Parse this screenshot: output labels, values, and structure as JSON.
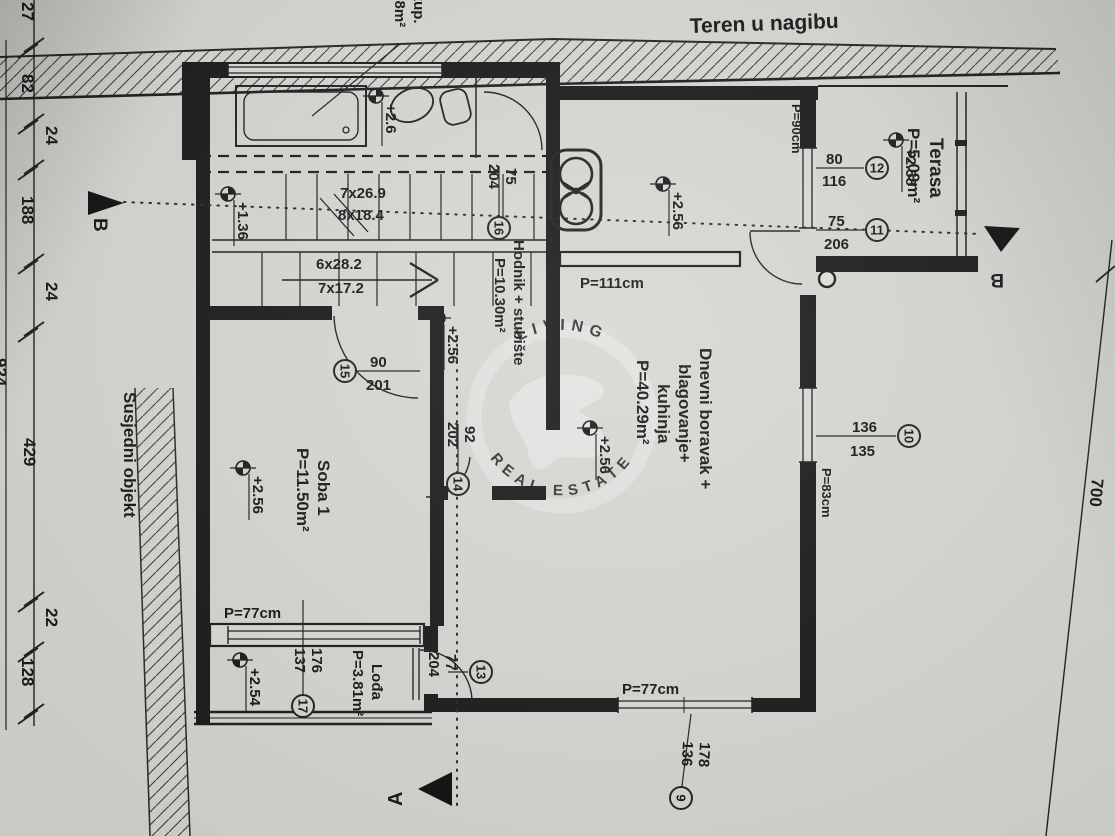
{
  "drawing": {
    "terrain_note": "Teren u nagibu",
    "neighbor_label": "Susjedni objekt",
    "sections": {
      "a": "A",
      "b": "B"
    },
    "watermark": {
      "arc_top": "LIVING",
      "arc_bottom": "REAL ESTATE"
    }
  },
  "rooms": {
    "bathroom": {
      "line1": "+kup.",
      "line2": ".38m²",
      "elevation": "+2.6"
    },
    "hodnik": {
      "name": "Hodnik + stubište",
      "area": "P=10.30m²",
      "elevation": "+2.56"
    },
    "kitchen_nook": {
      "elevation": "+2.56"
    },
    "living": {
      "line1": "Dnevni boravak +",
      "line2": "blagovanje+",
      "line3": "kuhinja",
      "area": "P=40.29m²",
      "elevation": "+2.56"
    },
    "soba1": {
      "name": "Soba 1",
      "area": "P=11.50m²",
      "elevation": "+2.56"
    },
    "lodja": {
      "name": "Lođa",
      "area": "P=3.81m²",
      "elevation": "+2.54"
    },
    "terasa": {
      "name": "Terasa",
      "area": "P=5.09m²",
      "elevation": "+2.58"
    },
    "stairs": {
      "flight1_line1": "7x26.9",
      "flight1_line2": "8x18.4",
      "flight2_line1": "6x28.2",
      "flight2_line2": "7x17.2",
      "landing_elevation": "+1.36"
    }
  },
  "openings": {
    "o9": {
      "num": "9",
      "w": "178",
      "h": "136"
    },
    "o10": {
      "num": "10",
      "w": "136",
      "h": "135"
    },
    "o11": {
      "num": "11",
      "w": "75",
      "h": "206"
    },
    "o12": {
      "num": "12",
      "w": "80",
      "h": "116"
    },
    "o13": {
      "num": "13",
      "w": "77",
      "h": "204"
    },
    "o14": {
      "num": "14",
      "w": "92",
      "h": "202"
    },
    "o15": {
      "num": "15",
      "w": "90",
      "h": "201"
    },
    "o16": {
      "num": "16",
      "w": "75",
      "h": "204"
    },
    "o17": {
      "num": "17",
      "w": "176",
      "h": "137"
    }
  },
  "parapets": {
    "kitchen": "P=111cm",
    "terasa": "P=90cm",
    "living_east": "P=83cm",
    "soba": "P=77cm",
    "living_south": "P=77cm"
  },
  "dimensions": {
    "left_chain": [
      "27",
      "82",
      "24",
      "188",
      "24",
      "429",
      "22",
      "128"
    ],
    "left_total": "924",
    "right_height": "700"
  }
}
